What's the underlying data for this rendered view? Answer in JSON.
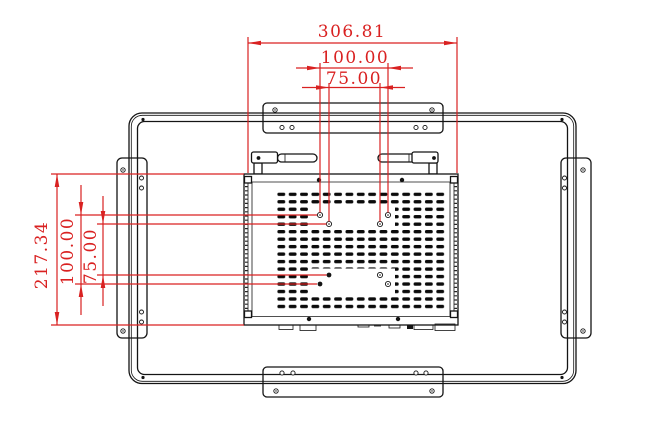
{
  "drawing": {
    "title": "open-frame-monitor-rear-mounting-drawing",
    "dimensions": {
      "horizontal": {
        "overall": "306.81",
        "vesa_100": "100.00",
        "vesa_75": "75.00"
      },
      "vertical": {
        "overall": "217.34",
        "vesa_100": "100.00",
        "vesa_75": "75.00"
      }
    },
    "colors": {
      "dimension_red": "#d92121",
      "line_black": "#141414",
      "background": "#ffffff"
    }
  }
}
